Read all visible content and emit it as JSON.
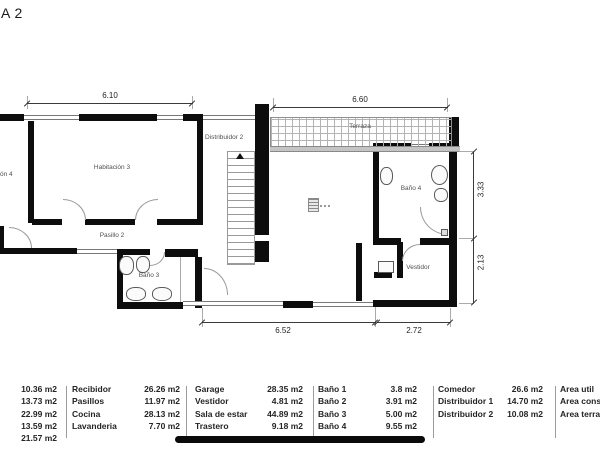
{
  "title": {
    "fragment": "A 2"
  },
  "plan": {
    "rooms": {
      "habitacion4_fragment": "ón 4",
      "habitacion3": "Habitación 3",
      "pasillo2": "Pasillo 2",
      "bano3": "Baño 3",
      "distribuidor2": "Distribuidor 2",
      "terraza": "Terraza",
      "bano4": "Baño 4",
      "vestidor": "Vestidor"
    },
    "dimensions": {
      "top_left": "6.10",
      "top_right": "6.60",
      "right_upper": "3.33",
      "right_lower": "2.13",
      "bottom_left": "6.52",
      "bottom_right": "2.72"
    },
    "colors": {
      "wall": "#0d0d0d",
      "thin_line": "#9a9a9a",
      "label": "#4f4f4f"
    }
  },
  "legend": {
    "groups": [
      {
        "rows": [
          {
            "value": "10.36 m2"
          },
          {
            "value": "13.73 m2"
          },
          {
            "value": "22.99 m2"
          },
          {
            "value": "13.59 m2"
          },
          {
            "value": "21.57 m2"
          }
        ]
      },
      {
        "rows": [
          {
            "label": "Recibidor",
            "value": "26.26 m2"
          },
          {
            "label": "Pasillos",
            "value": "11.97 m2"
          },
          {
            "label": "Cocina",
            "value": "28.13 m2"
          },
          {
            "label": "Lavanderia",
            "value": "7.70 m2"
          }
        ]
      },
      {
        "rows": [
          {
            "label": "Garage",
            "value": "28.35 m2"
          },
          {
            "label": "Vestidor",
            "value": "4.81 m2"
          },
          {
            "label": "Sala de estar",
            "value": "44.89 m2"
          },
          {
            "label": "Trastero",
            "value": "9.18 m2"
          }
        ]
      },
      {
        "rows": [
          {
            "label": "Baño 1",
            "value": "3.8 m2"
          },
          {
            "label": "Baño 2",
            "value": "3.91 m2"
          },
          {
            "label": "Baño 3",
            "value": "5.00 m2"
          },
          {
            "label": "Baño 4",
            "value": "9.55 m2"
          }
        ]
      },
      {
        "rows": [
          {
            "label": "Comedor",
            "value": "26.6 m2"
          },
          {
            "label": "Distribuidor 1",
            "value": "14.70 m2"
          },
          {
            "label": "Distribuidor 2",
            "value": "10.08 m2"
          }
        ]
      },
      {
        "rows": [
          {
            "label": "Area util"
          },
          {
            "label": "Area constr"
          },
          {
            "label": "Area terraza"
          }
        ]
      }
    ]
  }
}
